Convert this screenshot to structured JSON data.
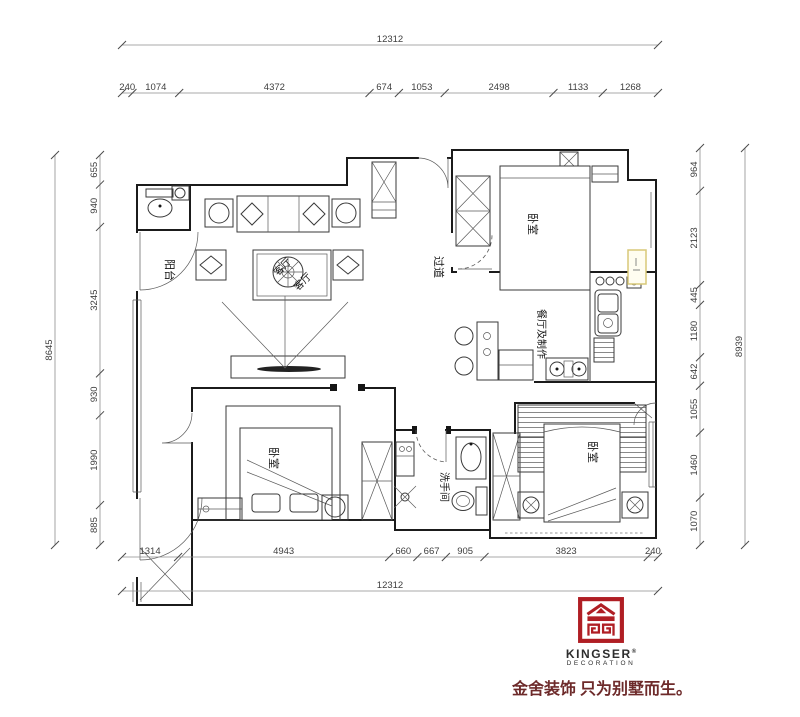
{
  "dimensions": {
    "top": {
      "overall": "12312",
      "segments": [
        "240",
        "1074",
        "4372",
        "674",
        "1053",
        "2498",
        "1133",
        "1268"
      ]
    },
    "bottom": {
      "overall": "12312",
      "segments": [
        "1314",
        "4943",
        "660",
        "667",
        "905",
        "3823",
        "240"
      ]
    },
    "left": {
      "overall": "8645",
      "segments": [
        "655",
        "940",
        "3245",
        "930",
        "1990",
        "885"
      ]
    },
    "right": {
      "overall": "8939",
      "segments": [
        "964",
        "2123",
        "445",
        "1180",
        "642",
        "1055",
        "1460",
        "1070"
      ]
    }
  },
  "rooms": {
    "balcony": "阳台",
    "living_a": "客厅",
    "living_b": "客厅",
    "hallway": "过道",
    "bedroom_top_right": "卧室",
    "dining_kitchen": "餐厅及制作",
    "bedroom_bottom_left": "卧室",
    "bathroom": "洗手间",
    "bedroom_bottom_right": "卧室"
  },
  "logo": {
    "brand": "KINGSER",
    "reg_mark": "®",
    "division": "DECORATION",
    "tagline": "金舍装饰 只为别墅而生。"
  },
  "colors": {
    "logo_red": "#b01e24",
    "tagline_red": "#6d2a2a",
    "highlight_fill": "#fffdf0",
    "highlight_border": "#d8c878",
    "wall_line": "#1b1b1b",
    "dim_text": "#3e3e3e"
  }
}
